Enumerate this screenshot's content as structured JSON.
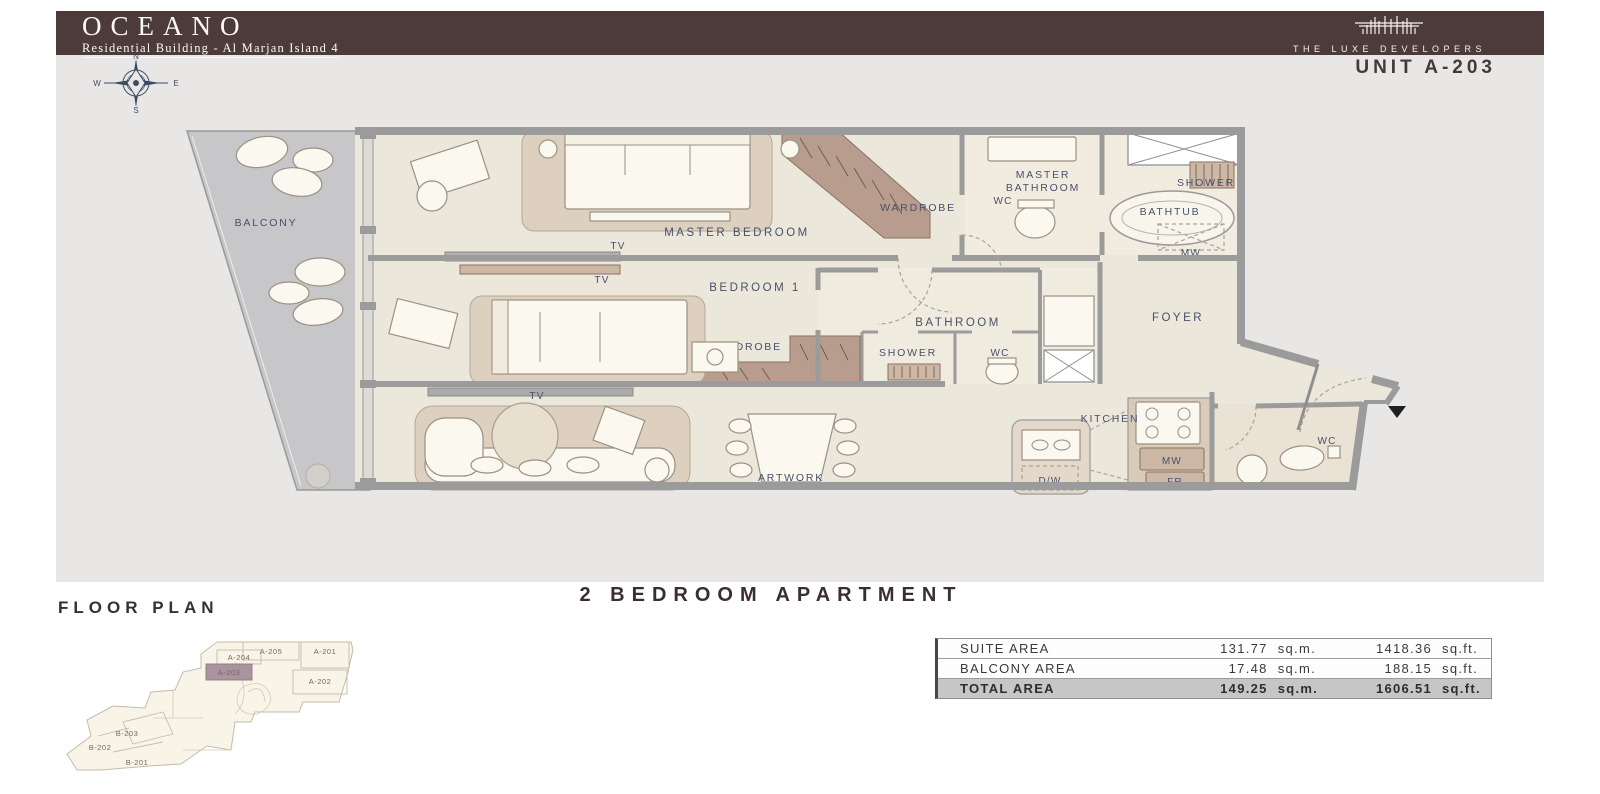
{
  "header": {
    "brand": "OCEANO",
    "subtitle": "Residential Building - Al Marjan Island 4",
    "developer": "THE LUXE DEVELOPERS",
    "unit_label": "UNIT A-203"
  },
  "compass": {
    "north": "N",
    "east": "E",
    "south": "S",
    "west": "W"
  },
  "plan": {
    "rooms": {
      "balcony": "BALCONY",
      "master_bedroom": "MASTER BEDROOM",
      "bedroom1": "BEDROOM 1",
      "wardrobe_master": "WARDROBE",
      "wardrobe_bedroom1": "WARDROBE",
      "master_bathroom_l1": "MASTER",
      "master_bathroom_l2": "BATHROOM",
      "wc_master": "WC",
      "shower_master": "SHOWER",
      "bathtub": "BATHTUB",
      "mw_foyer": "MW",
      "bathroom": "BATHROOM",
      "shower": "SHOWER",
      "wc_bathroom": "WC",
      "foyer": "FOYER",
      "kitchen": "KITCHEN",
      "dw": "D/W",
      "mw_kitchen": "MW",
      "fr": "FR",
      "wc_guest": "WC",
      "tv_master": "TV",
      "tv_bedroom1": "TV",
      "tv_living": "TV",
      "artwork": "ARTWORK"
    }
  },
  "mini_plan": {
    "title": "FLOOR PLAN",
    "units": [
      "A-205",
      "A-201",
      "A-204",
      "A-203",
      "A-202",
      "B-203",
      "B-202",
      "B-201"
    ],
    "highlighted_unit": "A-203"
  },
  "title": {
    "apartment_type": "2 BEDROOM APARTMENT"
  },
  "area_table": {
    "rows": [
      {
        "label": "SUITE AREA",
        "sqm": "131.77",
        "sqm_unit": "sq.m.",
        "sqft": "1418.36",
        "sqft_unit": "sq.ft."
      },
      {
        "label": "BALCONY AREA",
        "sqm": "17.48",
        "sqm_unit": "sq.m.",
        "sqft": "188.15",
        "sqft_unit": "sq.ft."
      },
      {
        "label": "TOTAL AREA",
        "sqm": "149.25",
        "sqm_unit": "sq.m.",
        "sqft": "1606.51",
        "sqft_unit": "sq.ft."
      }
    ]
  },
  "colors": {
    "brand_brown": "#4d3b3a",
    "panel_gray": "#e8e7e5",
    "floor_cream": "#ece7db",
    "wall_gray": "#9b9b9b",
    "balcony_gray": "#c7c6c8",
    "wardrobe_brown": "#b89d8f",
    "label_navy": "#47516b",
    "highlight_mauve": "#a8939e",
    "total_row_gray": "#c6c6c6"
  }
}
